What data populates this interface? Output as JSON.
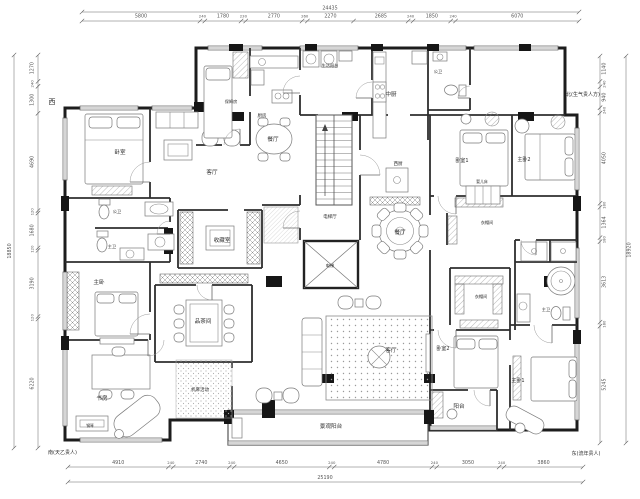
{
  "drawing": {
    "compass": {
      "west": "西",
      "north_annotation": "北(生气贵人方)",
      "south_annotation": "南(天乙贵人)",
      "east_annotation": "东(流年贵人)"
    },
    "dimensions_mm": {
      "top": {
        "total": "24435",
        "segments": [
          "5800",
          "240",
          "1780",
          "230",
          "2770",
          "260",
          "2270",
          "2685",
          "240",
          "1850",
          "240",
          "6070"
        ]
      },
      "bottom": {
        "total": "25190",
        "segments": [
          "4910",
          "240",
          "2740",
          "240",
          "4650",
          "240",
          "4780",
          "240",
          "3050",
          "240",
          "3860"
        ]
      },
      "left": {
        "total": "18850",
        "segments": [
          "1270",
          "240",
          "1300",
          "4690",
          "120",
          "1680",
          "120",
          "3190",
          "120",
          "6220"
        ]
      },
      "right": {
        "total": "18920",
        "segments": [
          "1140",
          "240",
          "940",
          "240",
          "4050",
          "180",
          "1364",
          "180",
          "3613",
          "180",
          "5245"
        ]
      }
    },
    "room_labels": [
      {
        "label": "卧室",
        "x": 120,
        "y": 154
      },
      {
        "label": "客厅",
        "x": 212,
        "y": 174
      },
      {
        "label": "餐厅",
        "x": 273,
        "y": 141
      },
      {
        "label": "厨房",
        "x": 262,
        "y": 117,
        "s": 4.5
      },
      {
        "label": "保姆房",
        "x": 231,
        "y": 103,
        "s": 4.2
      },
      {
        "label": "生活阳台",
        "x": 330,
        "y": 67,
        "s": 4.2
      },
      {
        "label": "中厨",
        "x": 391,
        "y": 96
      },
      {
        "label": "公卫",
        "x": 438,
        "y": 73,
        "s": 4.2
      },
      {
        "label": "西厨",
        "x": 398,
        "y": 165,
        "s": 4.5
      },
      {
        "label": "电梯厅",
        "x": 330,
        "y": 218,
        "s": 4.5
      },
      {
        "label": "电梯",
        "x": 330,
        "y": 267,
        "s": 4.2
      },
      {
        "label": "收藏室",
        "x": 222,
        "y": 242
      },
      {
        "label": "品茶间",
        "x": 203,
        "y": 323
      },
      {
        "label": "机麻活动",
        "x": 200,
        "y": 391,
        "s": 4.5
      },
      {
        "label": "主卧",
        "x": 99,
        "y": 284
      },
      {
        "label": "公卫",
        "x": 117,
        "y": 213,
        "s": 4.2
      },
      {
        "label": "主卫",
        "x": 112,
        "y": 248,
        "s": 4.2
      },
      {
        "label": "书房",
        "x": 102,
        "y": 400
      },
      {
        "label": "钢琴",
        "x": 90,
        "y": 427,
        "s": 3.8
      },
      {
        "label": "餐厅",
        "x": 400,
        "y": 234
      },
      {
        "label": "客厅",
        "x": 391,
        "y": 352
      },
      {
        "label": "卧室1",
        "x": 462,
        "y": 162,
        "s": 5
      },
      {
        "label": "婴儿床",
        "x": 482,
        "y": 183,
        "s": 3.8
      },
      {
        "label": "主卧2",
        "x": 524,
        "y": 161,
        "s": 5
      },
      {
        "label": "衣帽间",
        "x": 487,
        "y": 224,
        "s": 4.2
      },
      {
        "label": "衣帽间",
        "x": 481,
        "y": 298,
        "s": 4.2
      },
      {
        "label": "主卫",
        "x": 546,
        "y": 311,
        "s": 4.2
      },
      {
        "label": "卧室2",
        "x": 443,
        "y": 350,
        "s": 5
      },
      {
        "label": "主卧1",
        "x": 518,
        "y": 382,
        "s": 5
      },
      {
        "label": "阳台",
        "x": 459,
        "y": 408
      },
      {
        "label": "景观阳台",
        "x": 331,
        "y": 428
      }
    ]
  }
}
